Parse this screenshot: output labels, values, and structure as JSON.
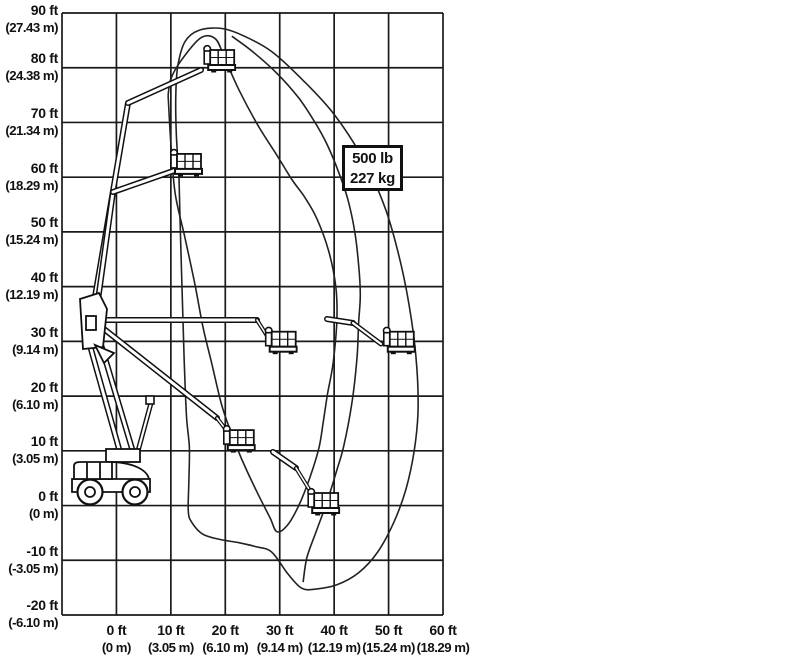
{
  "capacity_label": {
    "line1": "500 lb",
    "line2": "227 kg"
  },
  "chart_data": {
    "type": "line",
    "title": "",
    "description": "Articulating boom lift working envelope (reach chart) with platform positions",
    "grid": true,
    "xlim_ft": [
      -10,
      60
    ],
    "ylim_ft": [
      -20,
      90
    ],
    "x_axis": {
      "label": "horizontal reach",
      "ticks": [
        [
          "0 ft",
          "(0 m)"
        ],
        [
          "10 ft",
          "(3.05 m)"
        ],
        [
          "20 ft",
          "(6.10 m)"
        ],
        [
          "30 ft",
          "(9.14 m)"
        ],
        [
          "40 ft",
          "(12.19 m)"
        ],
        [
          "50 ft",
          "(15.24 m)"
        ],
        [
          "60 ft",
          "(18.29 m)"
        ]
      ]
    },
    "y_axis": {
      "label": "platform height",
      "ticks": [
        [
          "90 ft",
          "(27.43 m)"
        ],
        [
          "80 ft",
          "(24.38 m)"
        ],
        [
          "70 ft",
          "(21.34 m)"
        ],
        [
          "60 ft",
          "(18.29 m)"
        ],
        [
          "50 ft",
          "(15.24 m)"
        ],
        [
          "40 ft",
          "(12.19 m)"
        ],
        [
          "30 ft",
          "(9.14 m)"
        ],
        [
          "20 ft",
          "(6.10 m)"
        ],
        [
          "10 ft",
          "(3.05 m)"
        ],
        [
          "0 ft",
          "(0 m)"
        ],
        [
          "-10 ft",
          "(-3.05 m)"
        ],
        [
          "-20 ft",
          "(-6.10 m)"
        ]
      ]
    },
    "capacity_zone": {
      "label_lines": [
        "500 lb",
        "227 kg"
      ],
      "label_position_ft": [
        47,
        62
      ]
    },
    "series": [
      {
        "name": "outer_envelope",
        "points_ft": [
          [
            11.5,
            60
          ],
          [
            11,
            68
          ],
          [
            10.9,
            75
          ],
          [
            11.3,
            80.5
          ],
          [
            12.6,
            84.8
          ],
          [
            15.2,
            86.9
          ],
          [
            19.4,
            87.2
          ],
          [
            23.5,
            85.8
          ],
          [
            28.5,
            83
          ],
          [
            34,
            78
          ],
          [
            40,
            71.5
          ],
          [
            45.5,
            63
          ],
          [
            49.5,
            54
          ],
          [
            52.3,
            44
          ],
          [
            54.2,
            34
          ],
          [
            55.2,
            25
          ],
          [
            55.4,
            17
          ],
          [
            54.7,
            10
          ],
          [
            53.2,
            3
          ],
          [
            51,
            -3
          ],
          [
            48,
            -8.5
          ],
          [
            44.5,
            -12.3
          ],
          [
            40.5,
            -14.5
          ],
          [
            36.5,
            -15.3
          ],
          [
            34,
            -15.1
          ],
          [
            31.5,
            -12.5
          ],
          [
            28.5,
            -8.5
          ],
          [
            25.5,
            -7.5
          ],
          [
            22.5,
            -6.8
          ],
          [
            19,
            -6.2
          ],
          [
            15.8,
            -5.2
          ],
          [
            13.8,
            -3
          ],
          [
            13.2,
            -1
          ],
          [
            13.3,
            4
          ],
          [
            13.4,
            10.5
          ],
          [
            12.9,
            16
          ],
          [
            12.5,
            25
          ],
          [
            12.2,
            35
          ],
          [
            11.8,
            48
          ],
          [
            11.5,
            60
          ]
        ]
      },
      {
        "name": "mid_envelope",
        "points_ft": [
          [
            21.2,
            85.8
          ],
          [
            25,
            83
          ],
          [
            29.5,
            79
          ],
          [
            33.5,
            74.5
          ],
          [
            36.5,
            70
          ],
          [
            38.7,
            66
          ],
          [
            40.8,
            61
          ],
          [
            42.5,
            56
          ],
          [
            43.8,
            50
          ],
          [
            44.5,
            44
          ],
          [
            44.8,
            38.5
          ],
          [
            44.5,
            33.4
          ],
          [
            44.2,
            27
          ],
          [
            43.3,
            19
          ],
          [
            41.8,
            11
          ],
          [
            40.5,
            6.5
          ],
          [
            38.8,
            1
          ],
          [
            36.8,
            -4.5
          ],
          [
            35,
            -9.5
          ],
          [
            34.3,
            -14
          ]
        ]
      },
      {
        "name": "inner_envelope",
        "points_ft": [
          [
            9.5,
            75
          ],
          [
            10,
            66
          ],
          [
            10.8,
            57
          ],
          [
            12.6,
            48.9
          ],
          [
            14.5,
            40
          ],
          [
            15.9,
            32.6
          ],
          [
            17.5,
            26
          ],
          [
            19.3,
            18.5
          ],
          [
            20.9,
            13.8
          ],
          [
            23,
            8.5
          ],
          [
            25.8,
            2.5
          ],
          [
            28.2,
            -2.2
          ],
          [
            29.5,
            -4.8
          ],
          [
            31.5,
            -3.5
          ],
          [
            33.5,
            0
          ],
          [
            35.5,
            5
          ],
          [
            37.2,
            10.5
          ],
          [
            38,
            15.3
          ],
          [
            38.8,
            20.5
          ],
          [
            39.8,
            26
          ],
          [
            40.5,
            33.9
          ],
          [
            40.3,
            40
          ],
          [
            39,
            46.5
          ],
          [
            36.8,
            52.5
          ],
          [
            34.5,
            56.5
          ],
          [
            32.3,
            59.5
          ],
          [
            29.5,
            64
          ],
          [
            26,
            69.5
          ],
          [
            22.5,
            76
          ],
          [
            20,
            81.5
          ],
          [
            18.2,
            85.3
          ],
          [
            15.5,
            85.5
          ],
          [
            12,
            81.5
          ],
          [
            10,
            78
          ],
          [
            9.5,
            75
          ]
        ]
      }
    ],
    "platform_positions_ft": [
      [
        18.7,
        82
      ],
      [
        12.6,
        63
      ],
      [
        30,
        30.5
      ],
      [
        51.7,
        30.5
      ],
      [
        22.3,
        12.5
      ],
      [
        37.8,
        1
      ]
    ]
  }
}
